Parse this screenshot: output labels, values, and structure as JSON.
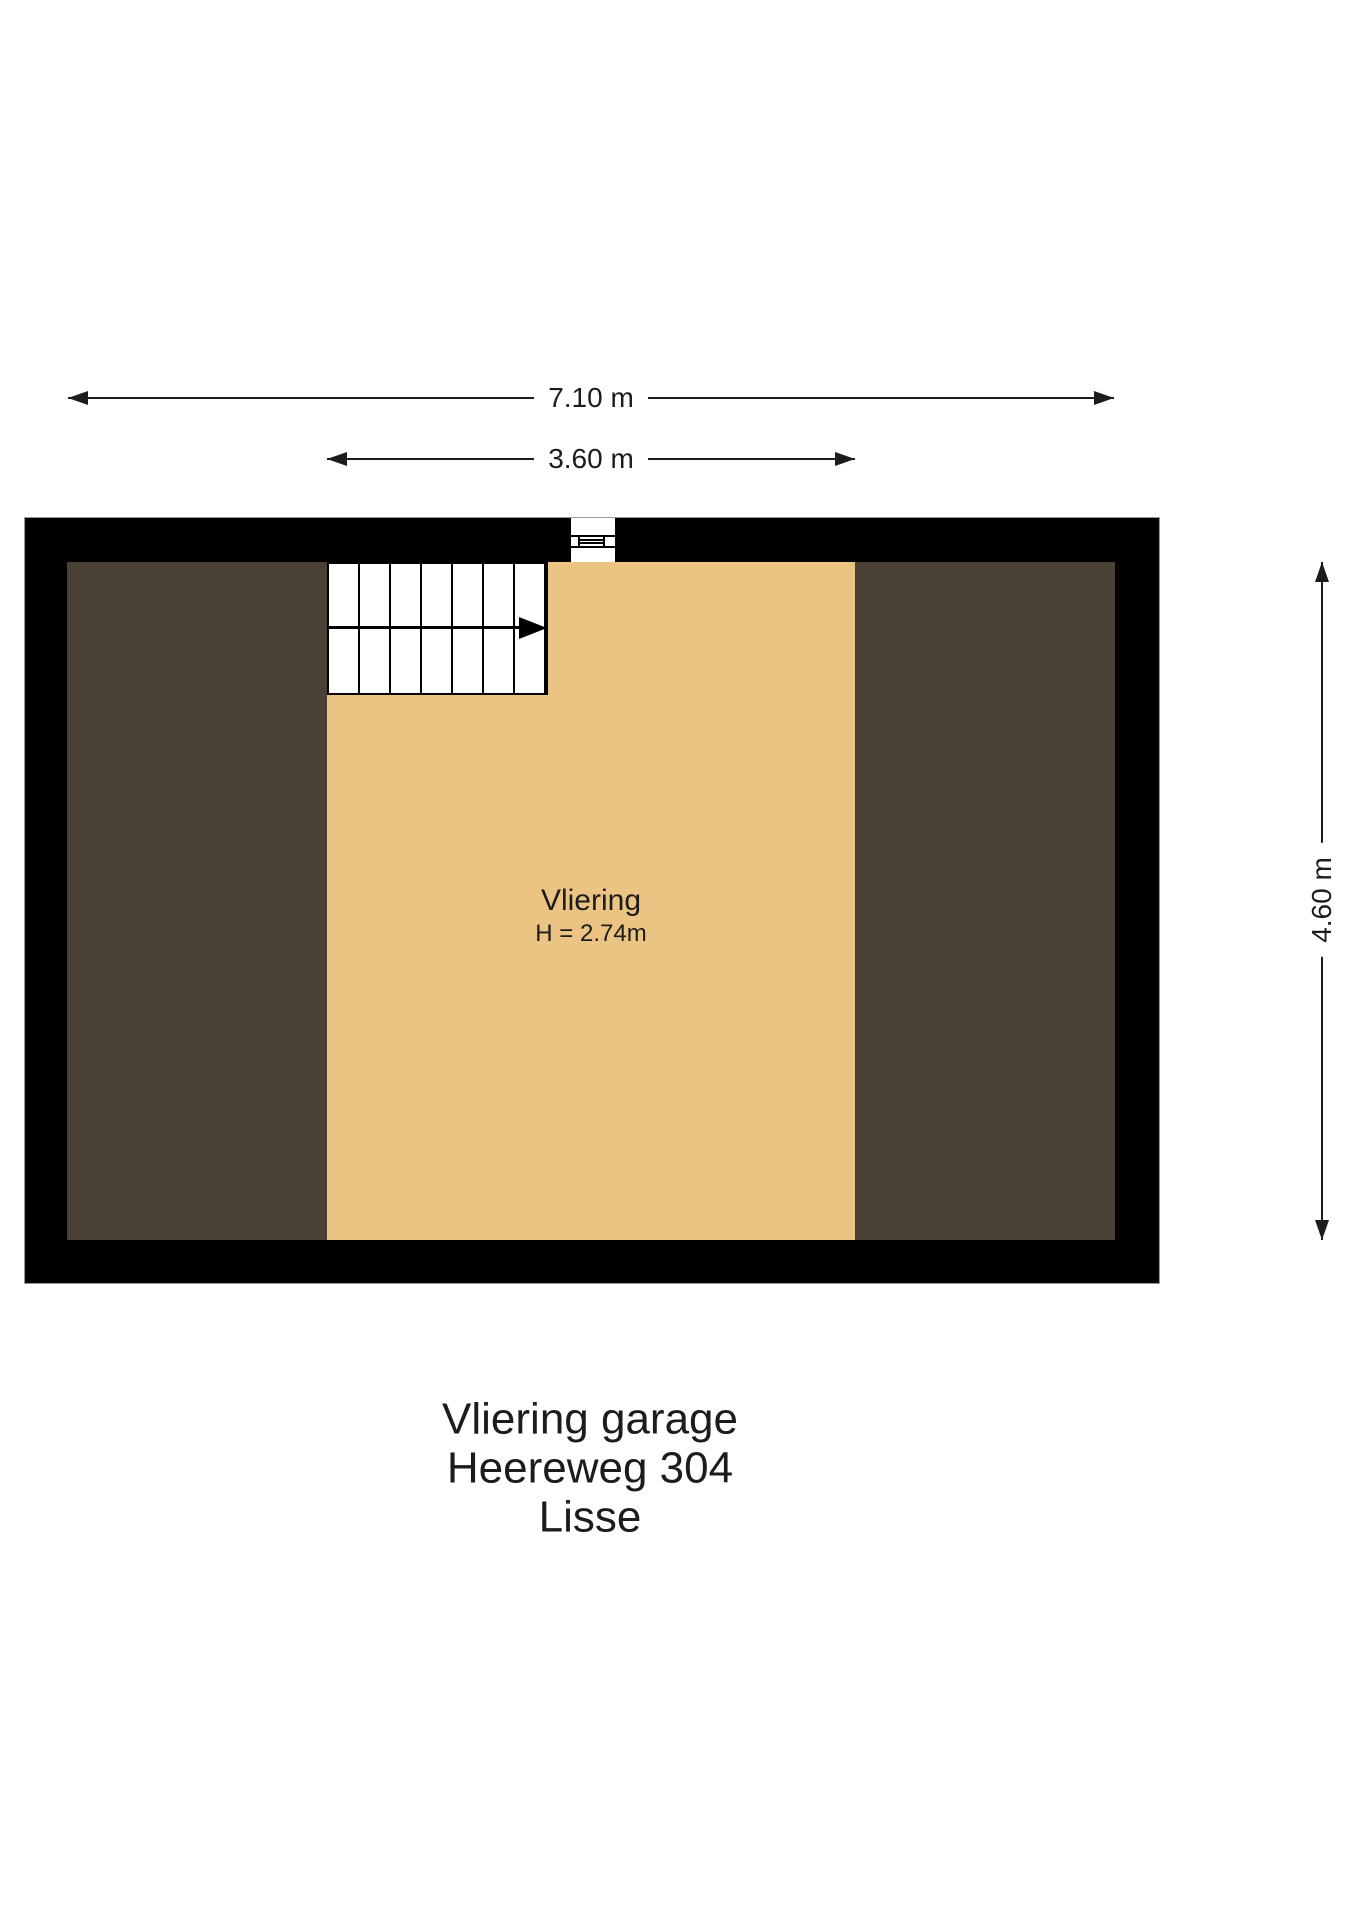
{
  "dimensions": {
    "total_width": "7.10 m",
    "center_width": "3.60 m",
    "total_height": "4.60 m"
  },
  "room": {
    "name": "Vliering",
    "height": "H = 2.74m"
  },
  "stairs": {
    "steps": 7,
    "direction": "right"
  },
  "title_block": {
    "line1": "Vliering garage",
    "line2": "Heereweg 304",
    "line3": "Lisse"
  },
  "colors": {
    "wall": "#000000",
    "floor_center": "#ebc484",
    "floor_side": "#494135",
    "outline": "#9a9a9a",
    "ink": "#1c1c1c"
  }
}
